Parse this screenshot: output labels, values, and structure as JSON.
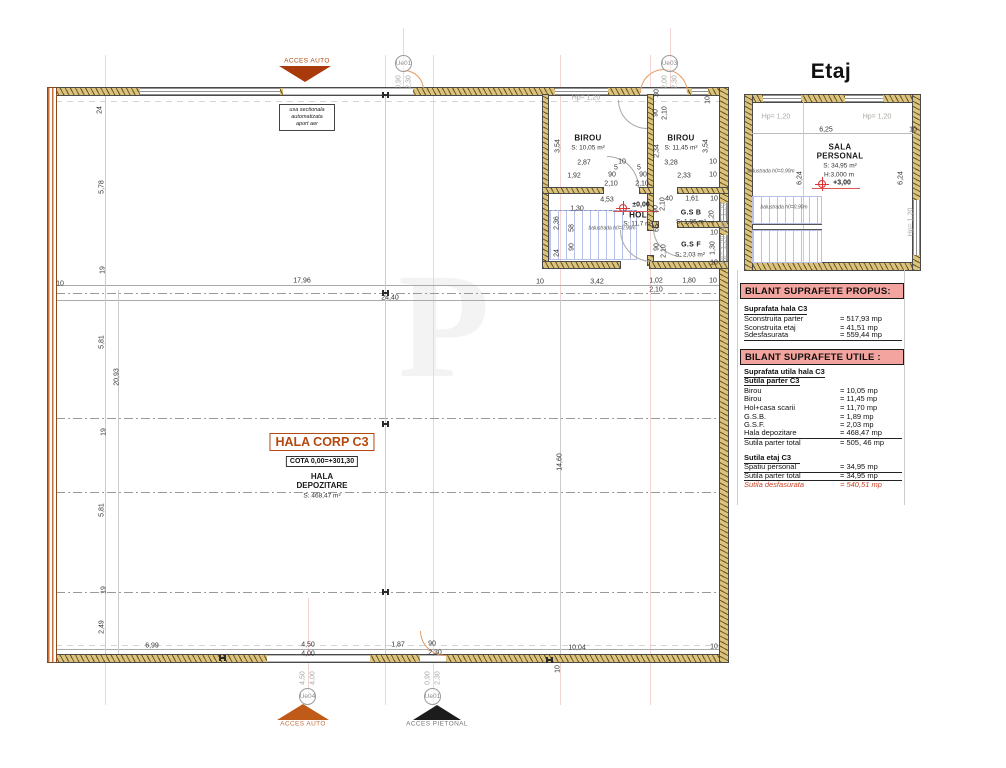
{
  "watermark": "P",
  "colors": {
    "accent_orange": "#b4490f",
    "table_header_pink": "#f4a49e",
    "level_red": "#d33333",
    "wall_tan": "#d9c37e",
    "wall_orange": "#c96f3a",
    "stairs_blue": "#b7c0e8"
  },
  "etaj": {
    "title": "Etaj",
    "room": {
      "name1": "SALA",
      "name2": "PERSONAL",
      "area": "S: 34,95 m²",
      "height": "H:3,000 m",
      "level": "+3,00"
    }
  },
  "parter": {
    "name": "HALA CORP C3",
    "cota": "COTA 0,00=+301,30",
    "hall_name": "HALA\nDEPOZITARE",
    "hall_area": "S: 468,47 m²"
  },
  "rooms": {
    "birou1": {
      "name": "BIROU",
      "area": "S: 10,05 m²"
    },
    "birou2": {
      "name": "BIROU",
      "area": "S: 11,45 m²"
    },
    "hol": {
      "name": "HOL",
      "area": "S: 11,7 m²",
      "level": "±0,00"
    },
    "gsb": {
      "name": "G.S B",
      "area": "S: 1,86 m²"
    },
    "gsf": {
      "name": "G.S F",
      "area": "S: 2,03 m²"
    }
  },
  "access": {
    "top": "ACCES AUTO",
    "bottom_auto": "ACCES AUTO",
    "bottom_pietonal": "ACCES PIETONAL",
    "usa": [
      "usa sectionala",
      "automatizata",
      "aport aer"
    ]
  },
  "door_tags": [
    {
      "id": "Ue01",
      "d1": "0,90",
      "d2": "2,30",
      "x": 404,
      "y": 64,
      "dy": 18
    },
    {
      "id": "Ue03",
      "d1": "2,00",
      "d2": "2,30",
      "x": 670,
      "y": 64,
      "dy": 18
    },
    {
      "id": "Ue04",
      "d1": "4,50",
      "d2": "4,00",
      "x": 308,
      "y": 697,
      "dy": -19
    },
    {
      "id": "Ue01",
      "d1": "0,90",
      "d2": "2,30",
      "x": 433,
      "y": 697,
      "dy": -19
    }
  ],
  "tables": {
    "propus": {
      "title": "BILANT SUPRAFETE PROPUS:",
      "rows": [
        {
          "l": "Suprafata hala C3",
          "v": "",
          "s": "head"
        },
        {
          "l": "Sconstruita parter",
          "v": "= 517,93 mp",
          "s": ""
        },
        {
          "l": "Sconstruita etaj",
          "v": "=  41,51 mp",
          "s": ""
        },
        {
          "l": "Sdesfasurata",
          "v": "= 559,44 mp",
          "s": "total"
        }
      ]
    },
    "utile": {
      "title": "BILANT SUPRAFETE UTILE :",
      "rows": [
        {
          "l": "Suprafata utila hala C3",
          "v": "",
          "s": "head"
        },
        {
          "l": "Sutila parter C3",
          "v": "",
          "s": "head"
        },
        {
          "l": "Birou",
          "v": "= 10,05 mp",
          "s": ""
        },
        {
          "l": "Birou",
          "v": "=  11,45 mp",
          "s": ""
        },
        {
          "l": "Hol+casa scarii",
          "v": "=  11,70 mp",
          "s": ""
        },
        {
          "l": "G.S.B.",
          "v": "=  1,89 mp",
          "s": ""
        },
        {
          "l": "G.S.F.",
          "v": "=  2,03 mp",
          "s": ""
        },
        {
          "l": "Hala depozitare",
          "v": "= 468,47 mp",
          "s": "line"
        },
        {
          "l": "Sutila parter total",
          "v": "= 505, 46 mp",
          "s": ""
        },
        {
          "l": "",
          "v": "",
          "s": "gap"
        },
        {
          "l": "Sutila etaj C3",
          "v": "",
          "s": "head"
        },
        {
          "l": "Spatiu personal",
          "v": "= 34,95 mp",
          "s": "line"
        },
        {
          "l": "Sutila parter total",
          "v": "= 34,95 mp",
          "s": "line"
        },
        {
          "l": "Sutila desfasurata",
          "v": "= 540,51 mp",
          "s": "red"
        }
      ]
    }
  },
  "dims": [
    [
      "24",
      100,
      110,
      1
    ],
    [
      "5,78",
      102,
      187,
      1
    ],
    [
      "19",
      103,
      270,
      1
    ],
    [
      "5,81",
      102,
      342,
      1
    ],
    [
      "20,93",
      117,
      377,
      1
    ],
    [
      "19",
      104,
      432,
      1
    ],
    [
      "5,81",
      102,
      510,
      1
    ],
    [
      "19",
      104,
      590,
      1
    ],
    [
      "2,49",
      102,
      627,
      1
    ],
    [
      "10",
      60,
      284,
      0
    ],
    [
      "17,96",
      302,
      281,
      0
    ],
    [
      "24,40",
      390,
      298,
      0
    ],
    [
      "10",
      540,
      282,
      0
    ],
    [
      "3,42",
      597,
      282,
      0
    ],
    [
      "1,02",
      656,
      281,
      0
    ],
    [
      "2,10",
      656,
      290,
      0
    ],
    [
      "1,80",
      689,
      281,
      0
    ],
    [
      "10",
      713,
      281,
      0
    ],
    [
      "14,60",
      560,
      462,
      1
    ],
    [
      "6,99",
      152,
      646,
      0
    ],
    [
      "4,50",
      308,
      645,
      0
    ],
    [
      "4,00",
      308,
      654,
      0
    ],
    [
      "1,87",
      398,
      645,
      0
    ],
    [
      "90",
      432,
      644,
      0
    ],
    [
      "2,30",
      435,
      653,
      0
    ],
    [
      "10,04",
      577,
      648,
      0
    ],
    [
      "10",
      714,
      647,
      0
    ],
    [
      "10",
      558,
      669,
      1
    ],
    [
      "Hp= 1,20",
      586,
      98,
      0,
      "grey"
    ],
    [
      "10",
      708,
      100,
      1
    ],
    [
      "30",
      657,
      93,
      1
    ],
    [
      "90",
      656,
      113,
      1
    ],
    [
      "2,10",
      665,
      113,
      1
    ],
    [
      "3,54",
      558,
      146,
      1
    ],
    [
      "2,34",
      657,
      151,
      1
    ],
    [
      "3,54",
      706,
      146,
      1
    ],
    [
      "2,87",
      584,
      163,
      0
    ],
    [
      "10",
      622,
      162,
      0
    ],
    [
      "3,28",
      671,
      163,
      0
    ],
    [
      "10",
      713,
      162,
      0
    ],
    [
      "1,92",
      574,
      176,
      0
    ],
    [
      "5",
      616,
      168,
      0
    ],
    [
      "5",
      639,
      168,
      0
    ],
    [
      "90",
      612,
      175,
      0
    ],
    [
      "90",
      643,
      175,
      0
    ],
    [
      "2,33",
      684,
      176,
      0
    ],
    [
      "10",
      713,
      175,
      0
    ],
    [
      "2,10",
      611,
      184,
      0
    ],
    [
      "2,10",
      642,
      184,
      0
    ],
    [
      "4,53",
      607,
      200,
      0
    ],
    [
      "1,30",
      577,
      209,
      0
    ],
    [
      "40",
      669,
      199,
      0
    ],
    [
      "1,61",
      692,
      199,
      0
    ],
    [
      "10",
      714,
      199,
      0
    ],
    [
      "2,10",
      663,
      204,
      1
    ],
    [
      "90",
      656,
      209,
      1
    ],
    [
      "2,36",
      557,
      223,
      1
    ],
    [
      "58",
      572,
      228,
      1
    ],
    [
      "65",
      657,
      228,
      1
    ],
    [
      "1,20",
      712,
      217,
      1
    ],
    [
      "10",
      714,
      233,
      0
    ],
    [
      "90",
      572,
      247,
      1
    ],
    [
      "24",
      557,
      253,
      1
    ],
    [
      "90",
      657,
      247,
      1
    ],
    [
      "2,10",
      664,
      251,
      1
    ],
    [
      "1,30",
      713,
      248,
      1
    ],
    [
      "10",
      714,
      263,
      0
    ],
    [
      "Hp= 1,20",
      724,
      217,
      1,
      "grey"
    ],
    [
      "Hp= 1,20",
      724,
      250,
      1,
      "grey"
    ],
    [
      "balustrada h0=0,90m",
      612,
      229,
      0,
      "tiny"
    ],
    [
      "6,25",
      826,
      130,
      0
    ],
    [
      "10",
      913,
      130,
      0
    ],
    [
      "6,24",
      800,
      178,
      1
    ],
    [
      "6,24",
      901,
      178,
      1
    ],
    [
      "Hp= 1,20",
      776,
      117,
      0,
      "grey"
    ],
    [
      "Hp= 1,20",
      877,
      117,
      0,
      "grey"
    ],
    [
      "Hp= 1,20",
      911,
      222,
      1,
      "grey"
    ],
    [
      "balustrada h0=0,90m",
      771,
      172,
      0,
      "tiny"
    ],
    [
      "balustrada h0=0,90m",
      784,
      208,
      0,
      "tiny"
    ]
  ]
}
